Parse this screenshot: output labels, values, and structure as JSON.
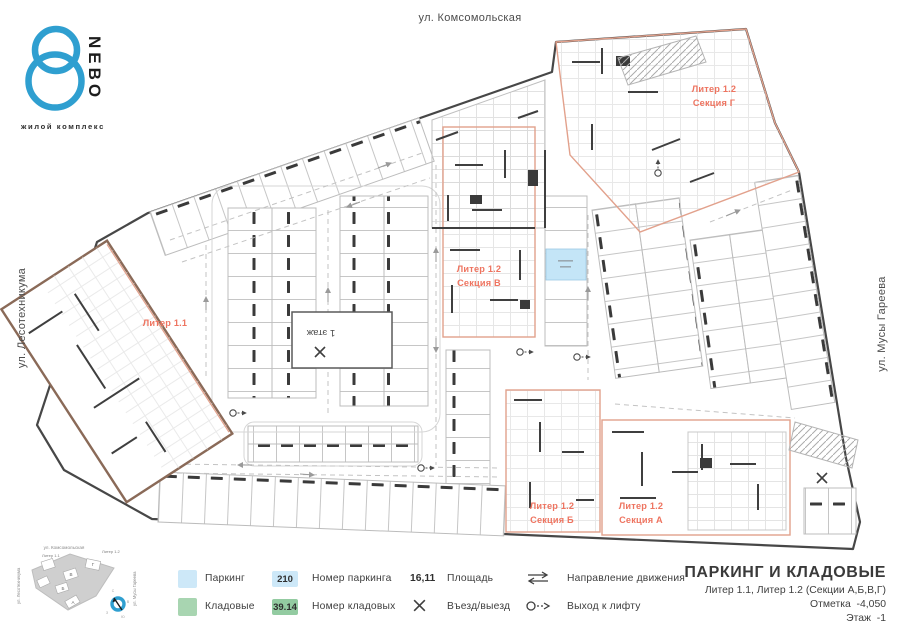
{
  "logo": {
    "brand": "NEBO",
    "tagline": "жилой комплекс"
  },
  "streets": {
    "top": "ул. Комсомольская",
    "left": "ул. Лесотехникума",
    "right": "ул. Мусы Гареева"
  },
  "plan_labels": {
    "liter_1_1": "Литер 1.1",
    "section_v": {
      "line1": "Литер 1.2",
      "line2": "Секция В"
    },
    "section_g": {
      "line1": "Литер 1.2",
      "line2": "Секция Г"
    },
    "section_b": {
      "line1": "Литер 1.2",
      "line2": "Секция Б"
    },
    "section_a": {
      "line1": "Литер 1.2",
      "line2": "Секция А"
    },
    "first_floor": "1 этаж"
  },
  "legend": {
    "parking_label": "Паркинг",
    "storage_label": "Кладовые",
    "parking_number_sample": "210",
    "parking_number_label": "Номер паркинга",
    "storage_number_sample": "39.14",
    "storage_number_label": "Номер кладовых",
    "area_sample": "16,11",
    "area_label": "Площадь",
    "entry_label": "Въезд/выезд",
    "direction_label": "Направление движения",
    "lift_label": "Выход к лифту"
  },
  "title_block": {
    "title": "ПАРКИНГ И КЛАДОВЫЕ",
    "subtitle": "Литер 1.1, Литер 1.2 (Секции А,Б,В,Г)",
    "elevation": "Отметка  -4,050",
    "floor": "Этаж  -1"
  },
  "minimap": {
    "street_top": "ул. Комсомольская",
    "street_left": "ул. Лесотехникума",
    "street_right": "ул. Мусы Гареева",
    "liter_1_1": "Литер 1.1",
    "liter_1_2": "Литер 1.2",
    "sections": [
      "Г",
      "В",
      "Б",
      "А"
    ],
    "compass": [
      "С",
      "В",
      "Ю",
      "З"
    ]
  },
  "colors": {
    "brand_blue": "#2f9fd0",
    "parking_fill": "#cde8f8",
    "storage_fill": "#a8d5b1",
    "section_accent": "#ee7460",
    "wall_dark": "#3f3f3f",
    "wall_brown": "#8a6a58"
  }
}
